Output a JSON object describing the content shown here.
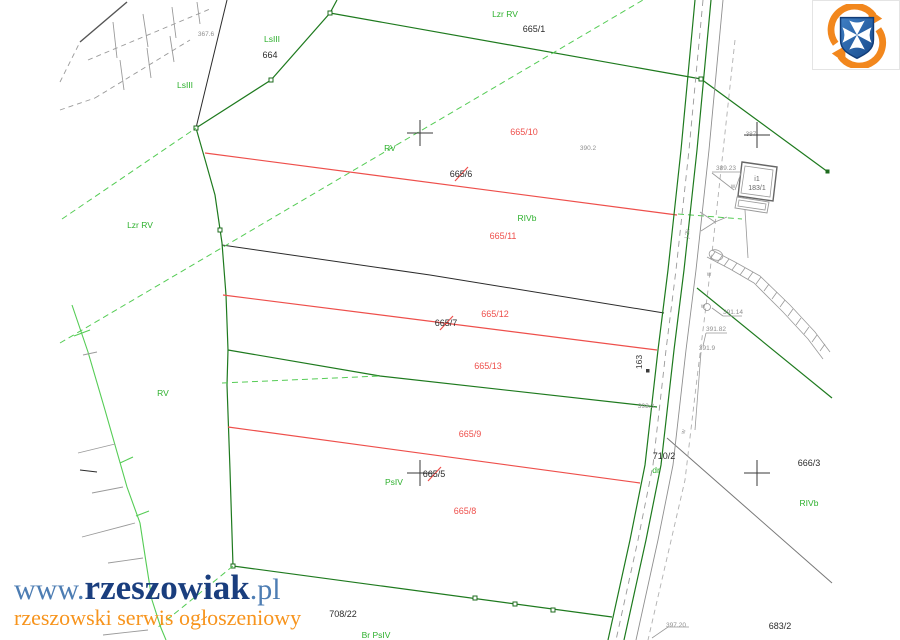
{
  "branding": {
    "site_url_prefix": "www.",
    "site_name": "rzeszowiak",
    "site_url_suffix": ".pl",
    "tagline": "rzeszowski serwis ogłoszeniowy",
    "emblem": "rzeszow-city-emblem-blue-shield-white-maltese-cross-orange-swoosh",
    "colors": {
      "navy": "#1a3e7e",
      "steel_blue": "#4d7db3",
      "orange": "#f7941d"
    }
  },
  "map": {
    "type": "cadastral-parcel-map",
    "colors": {
      "boundary_green": "#1e7a1e",
      "use_boundary_light_green": "#55cc55",
      "land_use_label_green": "#2db02d",
      "new_division_red": "#ee4f4b",
      "existing_boundary_black": "#2b2b2b",
      "annotation_gray": "#8f8f8f"
    },
    "parcel_numbers": {
      "n664": "664",
      "n665_1": "665/1",
      "n708_22": "708/22",
      "n710_2": "710/2",
      "n666_3": "666/3",
      "n683_2": "683/2"
    },
    "new_parcel_numbers_red": {
      "n665_10": "665/10",
      "n665_11": "665/11",
      "n665_12": "665/12",
      "n665_13": "665/13",
      "n665_9": "665/9",
      "n665_8": "665/8"
    },
    "cancelled_parcel_numbers": {
      "n665_6": "665/6",
      "n665_7": "665/7",
      "n665_5": "665/5"
    },
    "land_use_labels": {
      "lzr_rv_top": "Lzr RV",
      "lsiii_a": "LsIII",
      "lsiii_b": "LsIII",
      "lzr_rv_left": "Lzr RV",
      "rv_mid": "RV",
      "rv_left": "RV",
      "rivb_a": "RIVb",
      "rivb_b": "RIVb",
      "psiv": "PsIV",
      "br_psiv": "Br PsIV",
      "dr": "dr"
    },
    "spot_elevations": {
      "e367_6": "367.6",
      "e390_2": "390.2",
      "e387": "387",
      "e389_23": "389.23",
      "e391_14": "391.14",
      "e391_82": "391.82",
      "e391_9": "391.9",
      "e393_3": "393.3",
      "e397_20": "397.20"
    },
    "road": {
      "parcel": "710/2",
      "use_label": "dr",
      "axis_number": "163"
    },
    "building": {
      "storeys_code": "i1",
      "parcel": "183/1"
    },
    "utility_marks": {
      "water": "w",
      "pipe": "j.2k"
    }
  }
}
